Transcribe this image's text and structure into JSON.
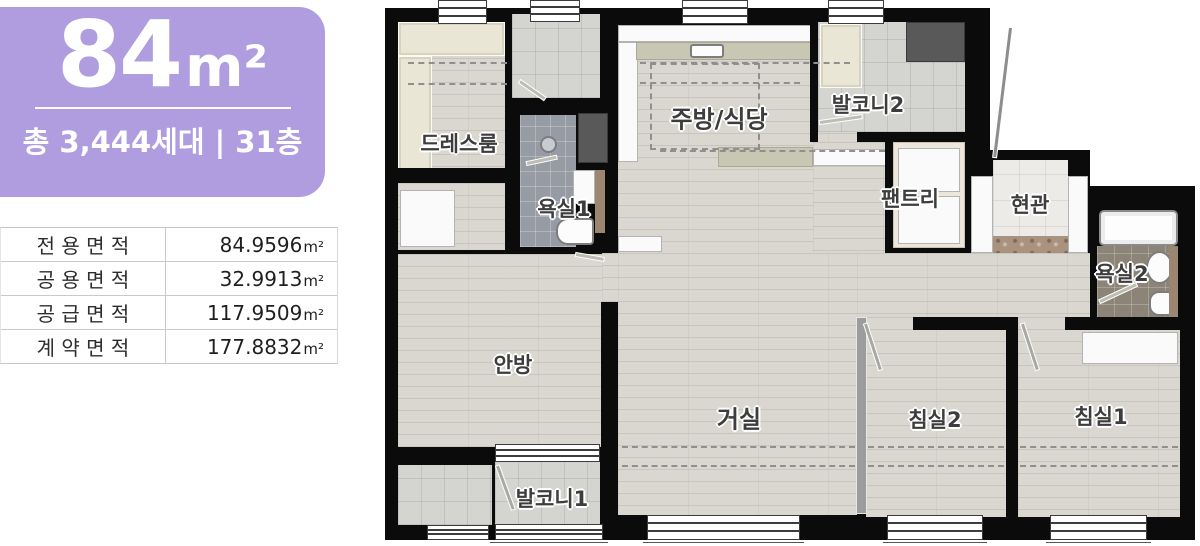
{
  "summary_card": {
    "area_value": "84",
    "area_unit": "m²",
    "line2": "총 3,444세대 | 31층",
    "bg_color": "#b09de0",
    "text_color": "#ffffff"
  },
  "area_table": {
    "rows": [
      {
        "label": "전 용 면 적",
        "value": "84.9596",
        "unit": "m²"
      },
      {
        "label": "공 용 면 적",
        "value": "32.9913",
        "unit": "m²"
      },
      {
        "label": "공 급 면 적",
        "value": "117.9509",
        "unit": "m²"
      },
      {
        "label": "계 약 면 적",
        "value": "177.8832",
        "unit": "m²"
      }
    ]
  },
  "floorplan": {
    "wall_color": "#0b0b0b",
    "rooms": {
      "dressroom": {
        "label": "드레스룸"
      },
      "bathroom1": {
        "label": "욕실1"
      },
      "kitchen_dining": {
        "label": "주방/식당"
      },
      "balcony2": {
        "label": "발코니2"
      },
      "pantry": {
        "label": "팬트리"
      },
      "entrance": {
        "label": "현관"
      },
      "bathroom2": {
        "label": "욕실2"
      },
      "master_bedroom": {
        "label": "안방"
      },
      "living_room": {
        "label": "거실"
      },
      "bedroom2": {
        "label": "침실2"
      },
      "bedroom1": {
        "label": "침실1"
      },
      "balcony1": {
        "label": "발코니1"
      }
    }
  }
}
